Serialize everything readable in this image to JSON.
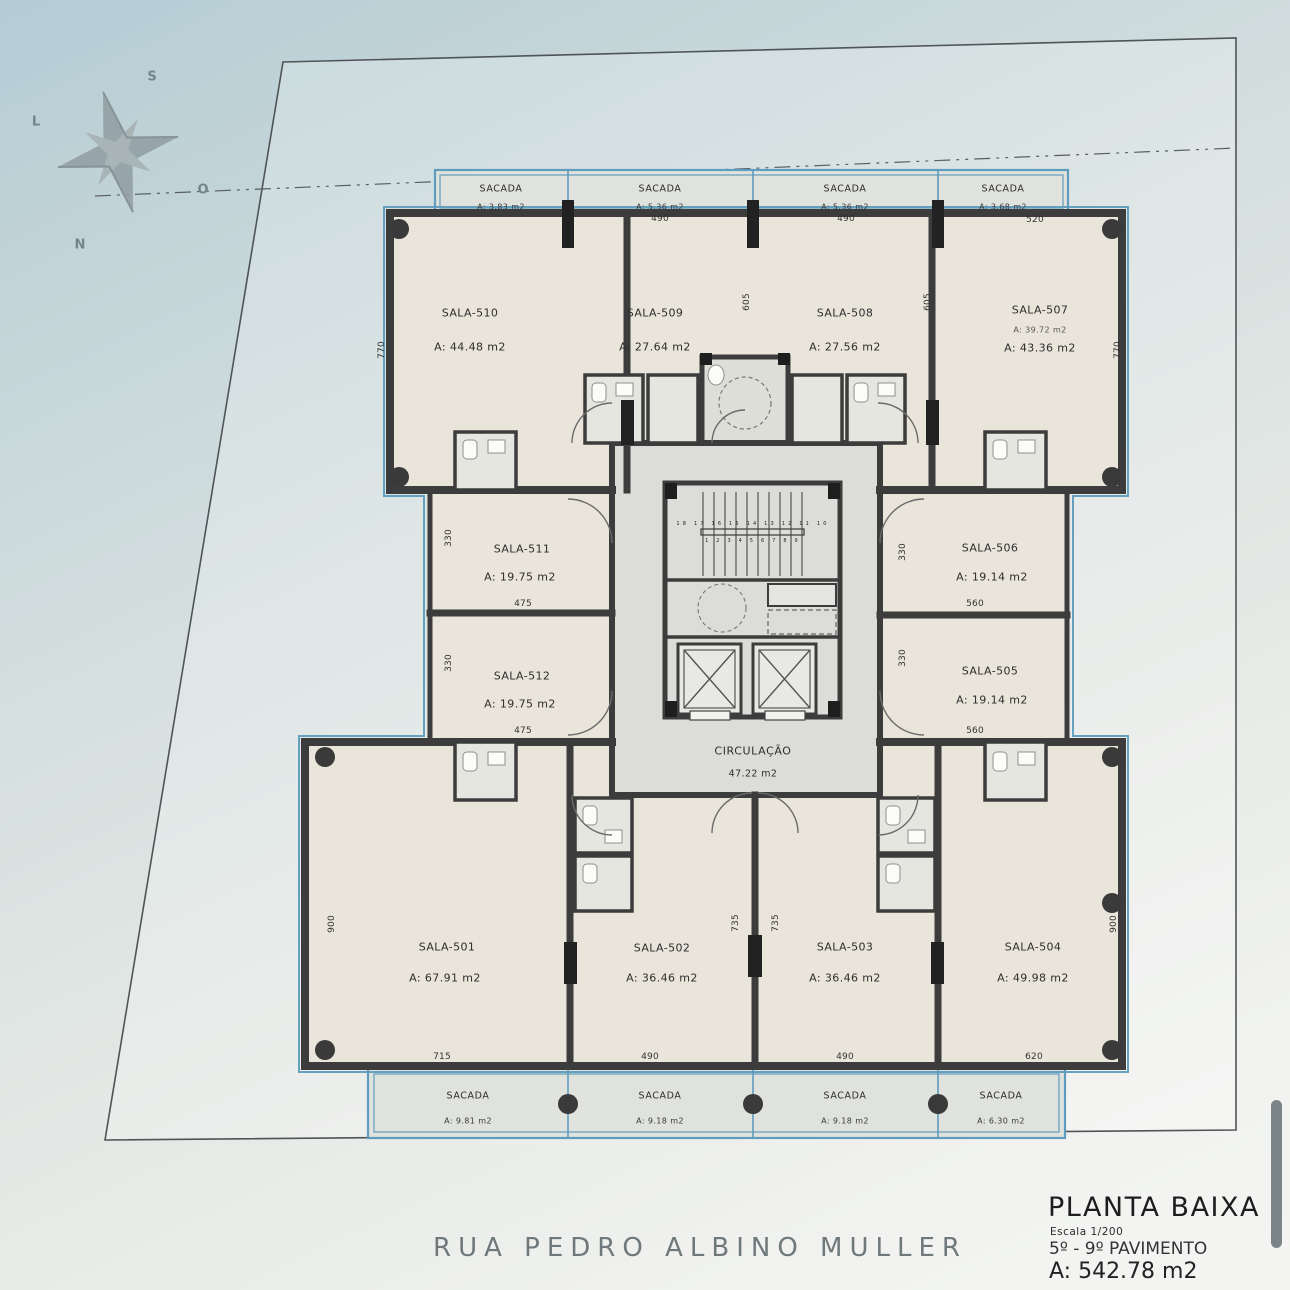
{
  "title_block": {
    "title": "PLANTA BAIXA",
    "scale": "Escala 1/200",
    "floors": "5º - 9º PAVIMENTO",
    "total_area": "A: 542.78 m2"
  },
  "street_name": "RUA PEDRO ALBINO MULLER",
  "compass": {
    "north": "N",
    "south": "S",
    "east": "L",
    "west": "O"
  },
  "circulation": {
    "name": "CIRCULAÇÃO",
    "area": "47.22 m2"
  },
  "rooms": [
    {
      "name": "SALA-501",
      "area": "A: 67.91 m2"
    },
    {
      "name": "SALA-502",
      "area": "A: 36.46 m2"
    },
    {
      "name": "SALA-503",
      "area": "A: 36.46 m2"
    },
    {
      "name": "SALA-504",
      "area": "A: 49.98 m2"
    },
    {
      "name": "SALA-505",
      "area": "A: 19.14 m2"
    },
    {
      "name": "SALA-506",
      "area": "A: 19.14 m2"
    },
    {
      "name": "SALA-507",
      "note": "A: 39.72 m2",
      "area": "A: 43.36 m2"
    },
    {
      "name": "SALA-508",
      "area": "A: 27.56 m2"
    },
    {
      "name": "SALA-509",
      "area": "A: 27.64 m2"
    },
    {
      "name": "SALA-510",
      "area": "A: 44.48 m2"
    },
    {
      "name": "SALA-511",
      "area": "A: 19.75 m2"
    },
    {
      "name": "SALA-512",
      "area": "A: 19.75 m2"
    }
  ],
  "balconies": {
    "label": "SACADA",
    "top": [
      {
        "area": "A: 3.83 m2"
      },
      {
        "area": "A: 5.36 m2"
      },
      {
        "area": "A: 5.36 m2"
      },
      {
        "area": "A: 3.68 m2"
      }
    ],
    "bottom": [
      {
        "area": "A: 9.81 m2"
      },
      {
        "area": "A: 9.18 m2"
      },
      {
        "area": "A: 9.18 m2"
      },
      {
        "area": "A: 6.30 m2"
      }
    ]
  },
  "dims": {
    "d330": "330",
    "d475": "475",
    "d490": "490",
    "d520": "520",
    "d560": "560",
    "d605": "605",
    "d620": "620",
    "d715": "715",
    "d735": "735",
    "d770": "770",
    "d900": "900"
  },
  "stairs": {
    "flight_up": "1 2 3 4 5 6 7 8 9",
    "flight_down": "18 17 16 15 14 13 12 11 10"
  },
  "colors": {
    "accent_blue": "#5f9cbd",
    "wall": "#3c3c3c",
    "room_fill": "#e9e5da",
    "core_fill": "#dcddd8"
  }
}
